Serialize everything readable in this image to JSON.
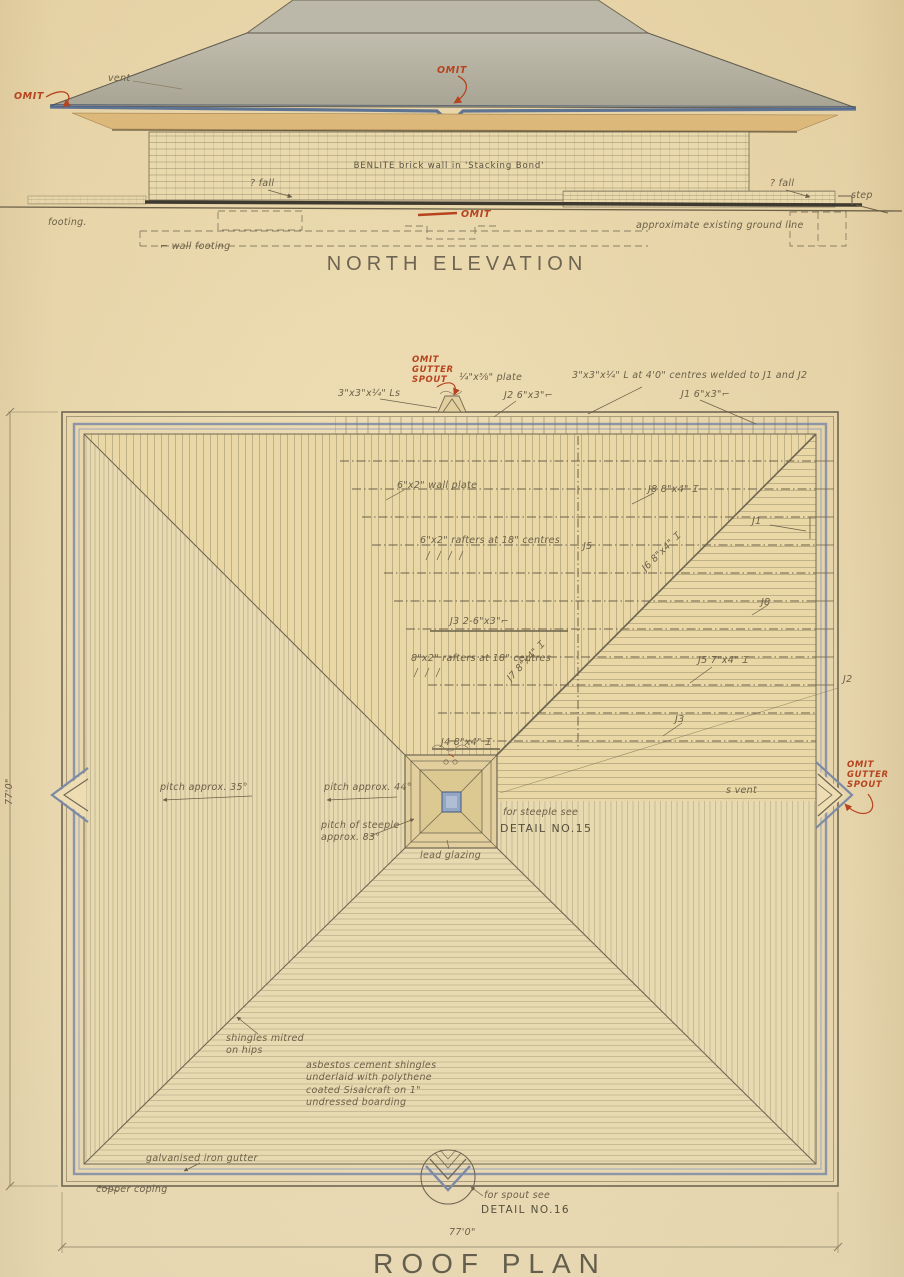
{
  "palette": {
    "paper": "#ecdaae",
    "pencil": "#6b6048",
    "ink_blue": "#46628f",
    "gutter_blue": "#7d8aa6",
    "ink_red": "#b5441f",
    "fascia_tan": "#dcb87b",
    "roof_gray": "#b3b0a0"
  },
  "north_elevation": {
    "title": "NORTH ELEVATION",
    "labels": [
      {
        "name": "vent-label",
        "text": "vent",
        "x": 108,
        "y": 73
      },
      {
        "name": "omit-left",
        "text": "OMIT",
        "x": 14,
        "y": 92,
        "cls": "red"
      },
      {
        "name": "omit-top",
        "text": "OMIT",
        "x": 437,
        "y": 66,
        "cls": "red"
      },
      {
        "name": "wall-material",
        "text": "BENLITE brick wall in 'Stacking Bond'",
        "x": 299,
        "y": 161,
        "cls": "typed",
        "w": 300,
        "align": "center"
      },
      {
        "name": "fall-left",
        "text": "? fall",
        "x": 250,
        "y": 178
      },
      {
        "name": "fall-right",
        "text": "? fall",
        "x": 770,
        "y": 178
      },
      {
        "name": "step-label",
        "text": "step",
        "x": 851,
        "y": 190
      },
      {
        "name": "footing-label",
        "text": "footing.",
        "x": 48,
        "y": 217
      },
      {
        "name": "wall-footing-label",
        "text": "⌐ wall footing",
        "x": 160,
        "y": 241
      },
      {
        "name": "omit-bottom",
        "text": "OMIT",
        "x": 461,
        "y": 210,
        "cls": "red"
      },
      {
        "name": "ground-line-label",
        "text": "approximate existing ground line",
        "x": 636,
        "y": 220
      }
    ]
  },
  "roof_plan": {
    "title": "ROOF PLAN",
    "labels": [
      {
        "name": "angle-cleats-label",
        "text": "3\"x3\"x¼\" Ls",
        "x": 338,
        "y": 388
      },
      {
        "name": "omit-gutter-spout-top",
        "text": "OMIT\nGUTTER\nSPOUT",
        "x": 412,
        "y": 356,
        "cls": "red",
        "size": 8.5
      },
      {
        "name": "plate-label",
        "text": "¼\"x⅝\" plate",
        "x": 459,
        "y": 372
      },
      {
        "name": "j2-top-label",
        "text": "J2  6\"x3\"⌐",
        "x": 504,
        "y": 390
      },
      {
        "name": "angle-centres-label",
        "text": "3\"x3\"x¼\" L at 4'0\" centres welded to J1 and J2",
        "x": 572,
        "y": 370
      },
      {
        "name": "j1-top-label",
        "text": "J1  6\"x3\"⌐",
        "x": 681,
        "y": 389
      },
      {
        "name": "wall-plate-label",
        "text": "6\"x2\" wall plate",
        "x": 397,
        "y": 480
      },
      {
        "name": "j8-upper-label",
        "text": "J8  8\"x4\" Ɪ",
        "x": 648,
        "y": 484
      },
      {
        "name": "rafters-label-1",
        "text": "6\"x2\" rafters at 18\" centres",
        "x": 420,
        "y": 535
      },
      {
        "name": "j5-mid-label",
        "text": "J5",
        "x": 583,
        "y": 541
      },
      {
        "name": "j6-diagonal-label",
        "text": "J6  8\"x4\" Ɪ",
        "x": 640,
        "y": 566,
        "rotate": -45
      },
      {
        "name": "j1-right-label",
        "text": "J1",
        "x": 752,
        "y": 516
      },
      {
        "name": "j8-right-label",
        "text": "J8",
        "x": 761,
        "y": 597
      },
      {
        "name": "j3-member-label",
        "text": "J3  2-6\"x3\"⌐",
        "x": 450,
        "y": 616
      },
      {
        "name": "rafters-label-2",
        "text": "8\"x2\" rafters at 18\" centres",
        "x": 411,
        "y": 653
      },
      {
        "name": "j7-diagonal-label",
        "text": "J7  8\"x4\" Ɪ",
        "x": 505,
        "y": 676,
        "rotate": -47
      },
      {
        "name": "j5-right-label",
        "text": "J5  7\"x4\" Ɪ",
        "x": 698,
        "y": 655
      },
      {
        "name": "j2-right-label",
        "text": "J2",
        "x": 843,
        "y": 674
      },
      {
        "name": "j3-small-label",
        "text": "J3",
        "x": 675,
        "y": 714
      },
      {
        "name": "j4-member-label",
        "text": "J4  8\"x4\" Ɪ",
        "x": 441,
        "y": 737
      },
      {
        "name": "pitch-35-label",
        "text": "pitch approx. 35°",
        "x": 160,
        "y": 782
      },
      {
        "name": "pitch-44-label",
        "text": "pitch approx. 44°",
        "x": 324,
        "y": 782
      },
      {
        "name": "pitch-steeple-label",
        "text": "pitch of steeple\napprox. 83°",
        "x": 321,
        "y": 820
      },
      {
        "name": "steeple-see-label",
        "text": "for steeple see",
        "x": 503,
        "y": 807
      },
      {
        "name": "steeple-detail-ref",
        "text": "DETAIL NO.15",
        "x": 500,
        "y": 822,
        "cls": "det",
        "size": 11
      },
      {
        "name": "lead-glazing-label",
        "text": "lead glazing",
        "x": 420,
        "y": 850
      },
      {
        "name": "vent-right-label",
        "text": "s vent",
        "x": 726,
        "y": 785
      },
      {
        "name": "omit-gutter-spout-right",
        "text": "OMIT\nGUTTER\nSPOUT",
        "x": 847,
        "y": 761,
        "cls": "red",
        "size": 8.5
      },
      {
        "name": "shingles-mitred-label",
        "text": "shingles mitred\non hips",
        "x": 226,
        "y": 1033
      },
      {
        "name": "asbestos-label",
        "text": "asbestos cement shingles\nunderlaid with polythene\ncoated Sisalcraft on 1\"\nundressed boarding",
        "x": 306,
        "y": 1060
      },
      {
        "name": "gutter-label",
        "text": "galvanised iron gutter",
        "x": 146,
        "y": 1153
      },
      {
        "name": "coping-label",
        "text": "copper coping",
        "x": 96,
        "y": 1184
      },
      {
        "name": "spout-see-label",
        "text": "for spout see",
        "x": 484,
        "y": 1190
      },
      {
        "name": "spout-detail-ref",
        "text": "DETAIL NO.16",
        "x": 481,
        "y": 1204,
        "cls": "det",
        "size": 10.5
      },
      {
        "name": "dim-bottom",
        "text": "77'0\"",
        "x": 449,
        "y": 1227
      },
      {
        "name": "dim-left",
        "text": "77'0\"",
        "x": 4,
        "y": 805,
        "rotate": -90
      }
    ]
  }
}
